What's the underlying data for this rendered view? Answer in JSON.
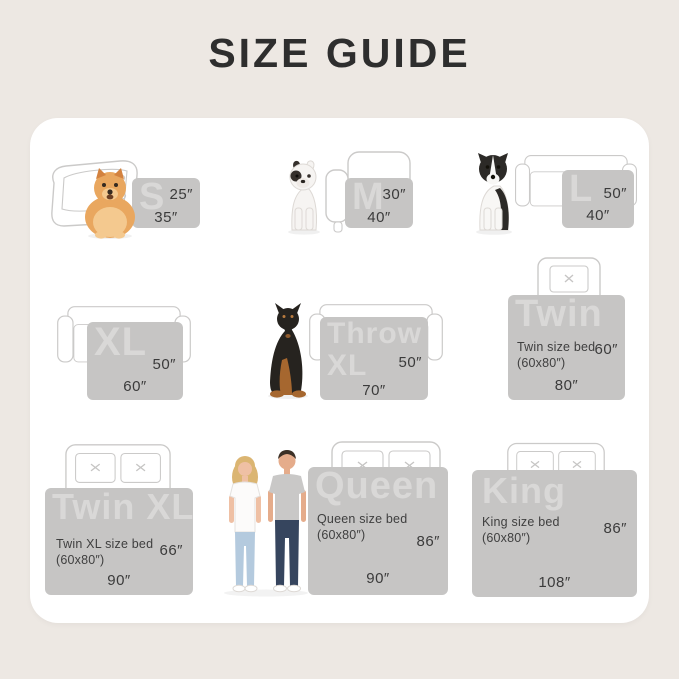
{
  "page": {
    "title": "SIZE GUIDE",
    "background_color": "#EDE8E3",
    "card_color": "#FFFFFF",
    "swatch_color": "#C6C5C4",
    "swatch_label_color": "#D9D8D7",
    "dimension_text_color": "#3B3B3B",
    "outline_color": "#CBCAC9"
  },
  "sizes": [
    {
      "id": "s",
      "label": "S",
      "height": "25″",
      "width": "35″",
      "illustration": "pomeranian dog with dog bed"
    },
    {
      "id": "m",
      "label": "M",
      "height": "30″",
      "width": "40″",
      "illustration": "french bulldog with armchair"
    },
    {
      "id": "l",
      "label": "L",
      "height": "50″",
      "width": "40″",
      "illustration": "border collie with sofa"
    },
    {
      "id": "xl",
      "label": "XL",
      "height": "50″",
      "width": "60″",
      "illustration": "sofa"
    },
    {
      "id": "throw_xl",
      "label": "Throw XL",
      "height": "50″",
      "width": "70″",
      "illustration": "doberman with sofa"
    },
    {
      "id": "twin",
      "label": "Twin",
      "sublabel_line1": "Twin size bed",
      "sublabel_line2": "(60x80″)",
      "height": "60″",
      "width": "80″",
      "illustration": "twin bed with one pillow"
    },
    {
      "id": "twin_xl",
      "label": "Twin XL",
      "sublabel_line1": "Twin XL size bed",
      "sublabel_line2": "(60x80″)",
      "height": "66″",
      "width": "90″",
      "illustration": "bed with two pillows"
    },
    {
      "id": "queen",
      "label": "Queen",
      "sublabel_line1": "Queen size bed",
      "sublabel_line2": "(60x80″)",
      "height": "86″",
      "width": "90″",
      "illustration": "couple with queen bed"
    },
    {
      "id": "king",
      "label": "King",
      "sublabel_line1": "King size bed",
      "sublabel_line2": "(60x80″)",
      "height": "86″",
      "width": "108″",
      "illustration": "king bed with two pillows"
    }
  ]
}
